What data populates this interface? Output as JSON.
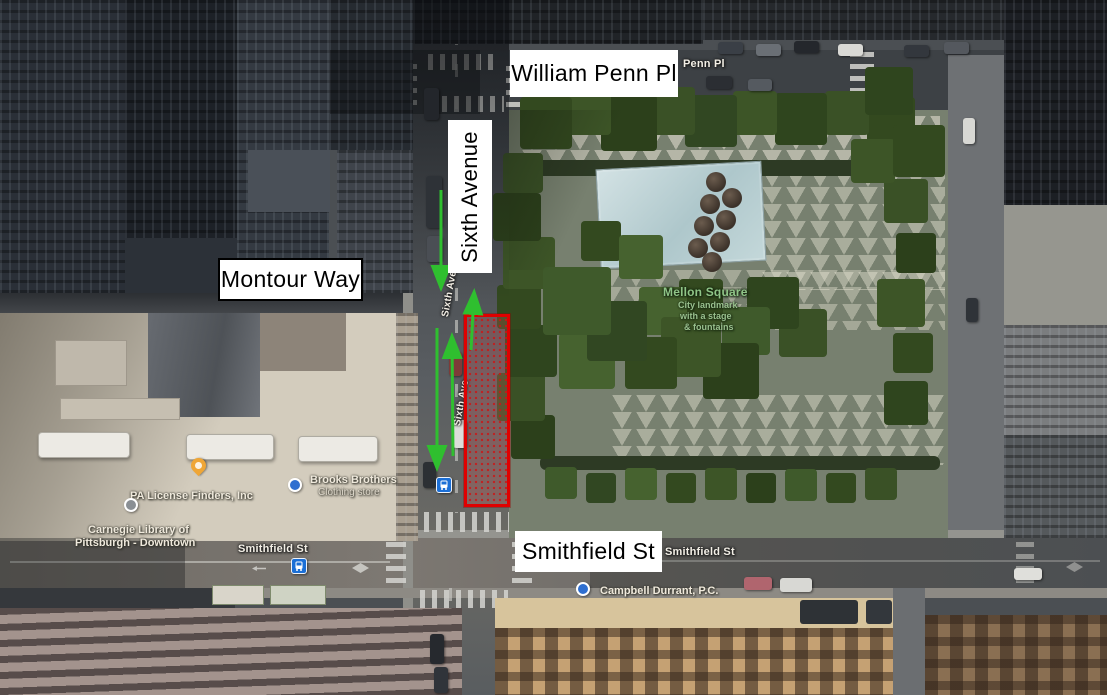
{
  "scene": {
    "description": "Aerial satellite view of downtown Pittsburgh around Mellon Square with street annotations",
    "colors": {
      "highlight_red": "#E00000",
      "route_arrow_green": "#2FBF2F",
      "transit_blue": "#1B6FD6",
      "park_label_green": "#8FC487"
    }
  },
  "overlay_labels": {
    "william_penn_pl": "William Penn Pl",
    "sixth_avenue": "Sixth Avenue",
    "montour_way": "Montour Way",
    "smithfield_st": "Smithfield St"
  },
  "map_labels": {
    "penn_pl": "Penn Pl",
    "smithfield_west": "Smithfield St",
    "smithfield_east": "Smithfield St",
    "sixth_ave_upper": "Sixth Ave",
    "sixth_ave_lower": "Sixth Ave",
    "mellon_square": {
      "title": "Mellon Square",
      "desc_line1": "City landmark",
      "desc_line2": "with a stage",
      "desc_line3": "& fountains"
    },
    "pa_license_finders": "PA License Finders, Inc",
    "brooks_brothers": {
      "name": "Brooks Brothers",
      "category": "Clothing store"
    },
    "carnegie_library": {
      "line1": "Carnegie Library of",
      "line2": "Pittsburgh - Downtown"
    },
    "campbell_durrant": "Campbell Durrant, P.C."
  }
}
